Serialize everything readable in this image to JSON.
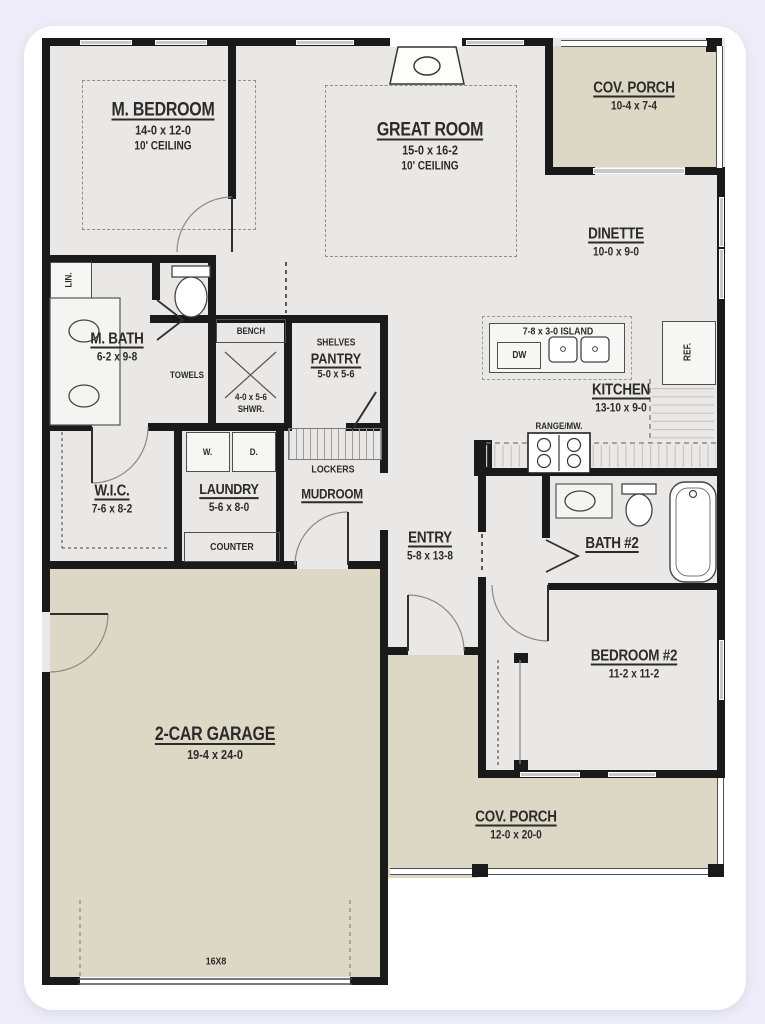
{
  "rooms": {
    "m_bedroom": {
      "name": "M. BEDROOM",
      "dims": "14-0 x 12-0",
      "ceiling": "10' CEILING"
    },
    "great_room": {
      "name": "GREAT ROOM",
      "dims": "15-0 x 16-2",
      "ceiling": "10' CEILING"
    },
    "cov_porch_upper": {
      "name": "COV. PORCH",
      "dims": "10-4 x 7-4"
    },
    "dinette": {
      "name": "DINETTE",
      "dims": "10-0 x 9-0"
    },
    "kitchen": {
      "name": "KITCHEN",
      "dims": "13-10 x 9-0"
    },
    "m_bath": {
      "name": "M. BATH",
      "dims": "6-2 x 9-8"
    },
    "shower": {
      "name": "SHWR.",
      "dims": "4-0 x 5-6"
    },
    "pantry": {
      "name": "PANTRY",
      "dims": "5-0 x 5-6",
      "shelf_label": "SHELVES"
    },
    "wic": {
      "name": "W.I.C.",
      "dims": "7-6 x 8-2"
    },
    "laundry": {
      "name": "LAUNDRY",
      "dims": "5-6 x 8-0"
    },
    "mudroom": {
      "name": "MUDROOM"
    },
    "entry": {
      "name": "ENTRY",
      "dims": "5-8 x 13-8"
    },
    "bath_2": {
      "name": "BATH #2"
    },
    "bedroom_2": {
      "name": "BEDROOM #2",
      "dims": "11-2 x 11-2"
    },
    "garage": {
      "name": "2-CAR GARAGE",
      "dims": "19-4 x 24-0"
    },
    "cov_porch_lower": {
      "name": "COV. PORCH",
      "dims": "12-0 x 20-0"
    }
  },
  "fixtures": {
    "island": "7-8 x 3-0 ISLAND",
    "dishwasher": "DW",
    "refrigerator": "REF.",
    "range": "RANGE/MW.",
    "linen": "LIN.",
    "towels": "TOWELS",
    "bench": "BENCH",
    "counter": "COUNTER",
    "lockers": "LOCKERS",
    "washer": "W.",
    "dryer": "D.",
    "garage_door": "16X8"
  },
  "colors": {
    "bg": "#edecf8",
    "card": "#ffffff",
    "wall": "#1a1a1a",
    "floor": "#e9e8e6",
    "porch": "#ddd7c5",
    "window": "#c8c8c8",
    "line": "#555555",
    "text": "#2b2b2b"
  }
}
